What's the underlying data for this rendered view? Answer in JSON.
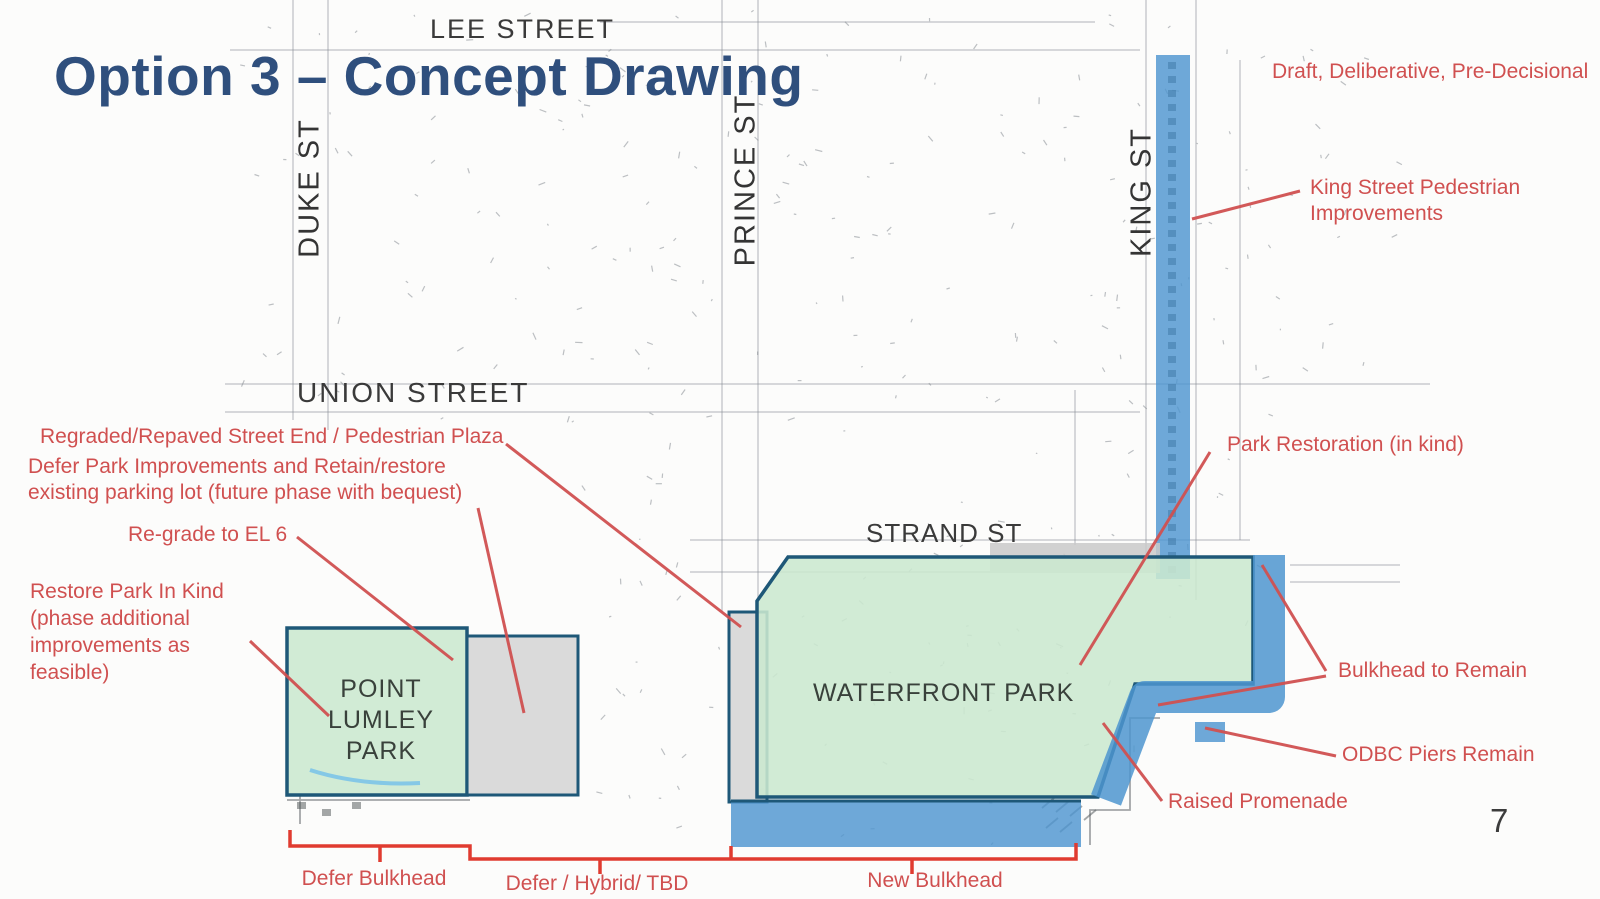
{
  "slide": {
    "title": "Option 3 – Concept Drawing",
    "watermark": "Draft, Deliberative, Pre-Decisional",
    "page_number": "7"
  },
  "streets": {
    "lee": "LEE STREET",
    "duke": "DUKE ST",
    "prince": "PRINCE ST",
    "king": "KING ST",
    "union": "UNION STREET",
    "strand": "STRAND ST"
  },
  "areas": {
    "point_lumley": "POINT\nLUMLEY\nPARK",
    "waterfront": "WATERFRONT PARK"
  },
  "annotations": {
    "king_street": "King Street Pedestrian\nImprovements",
    "park_restoration": "Park Restoration (in kind)",
    "regraded_street_end": "Regraded/Repaved Street End / Pedestrian Plaza",
    "defer_park": "Defer Park Improvements and Retain/restore\nexisting parking lot (future phase with bequest)",
    "regrade_el6": "Re-grade to EL 6",
    "restore_park": "Restore Park In Kind\n(phase additional\nimprovements as\nfeasible)",
    "bulkhead_remain": "Bulkhead to Remain",
    "odbc_piers": "ODBC Piers Remain",
    "raised_promenade": "Raised Promenade",
    "defer_bulkhead": "Defer Bulkhead",
    "defer_hybrid": "Defer / Hybrid/ TBD",
    "new_bulkhead": "New Bulkhead"
  },
  "colors": {
    "title_blue": "#2F4F7D",
    "annotation_red": "#D05050",
    "park_green": "#CBE8CF",
    "overlay_blue": "#4E95CF",
    "outline_dark": "#1E5878",
    "map_gray": "#8B9096",
    "parking_gray": "#D6D6D6"
  }
}
